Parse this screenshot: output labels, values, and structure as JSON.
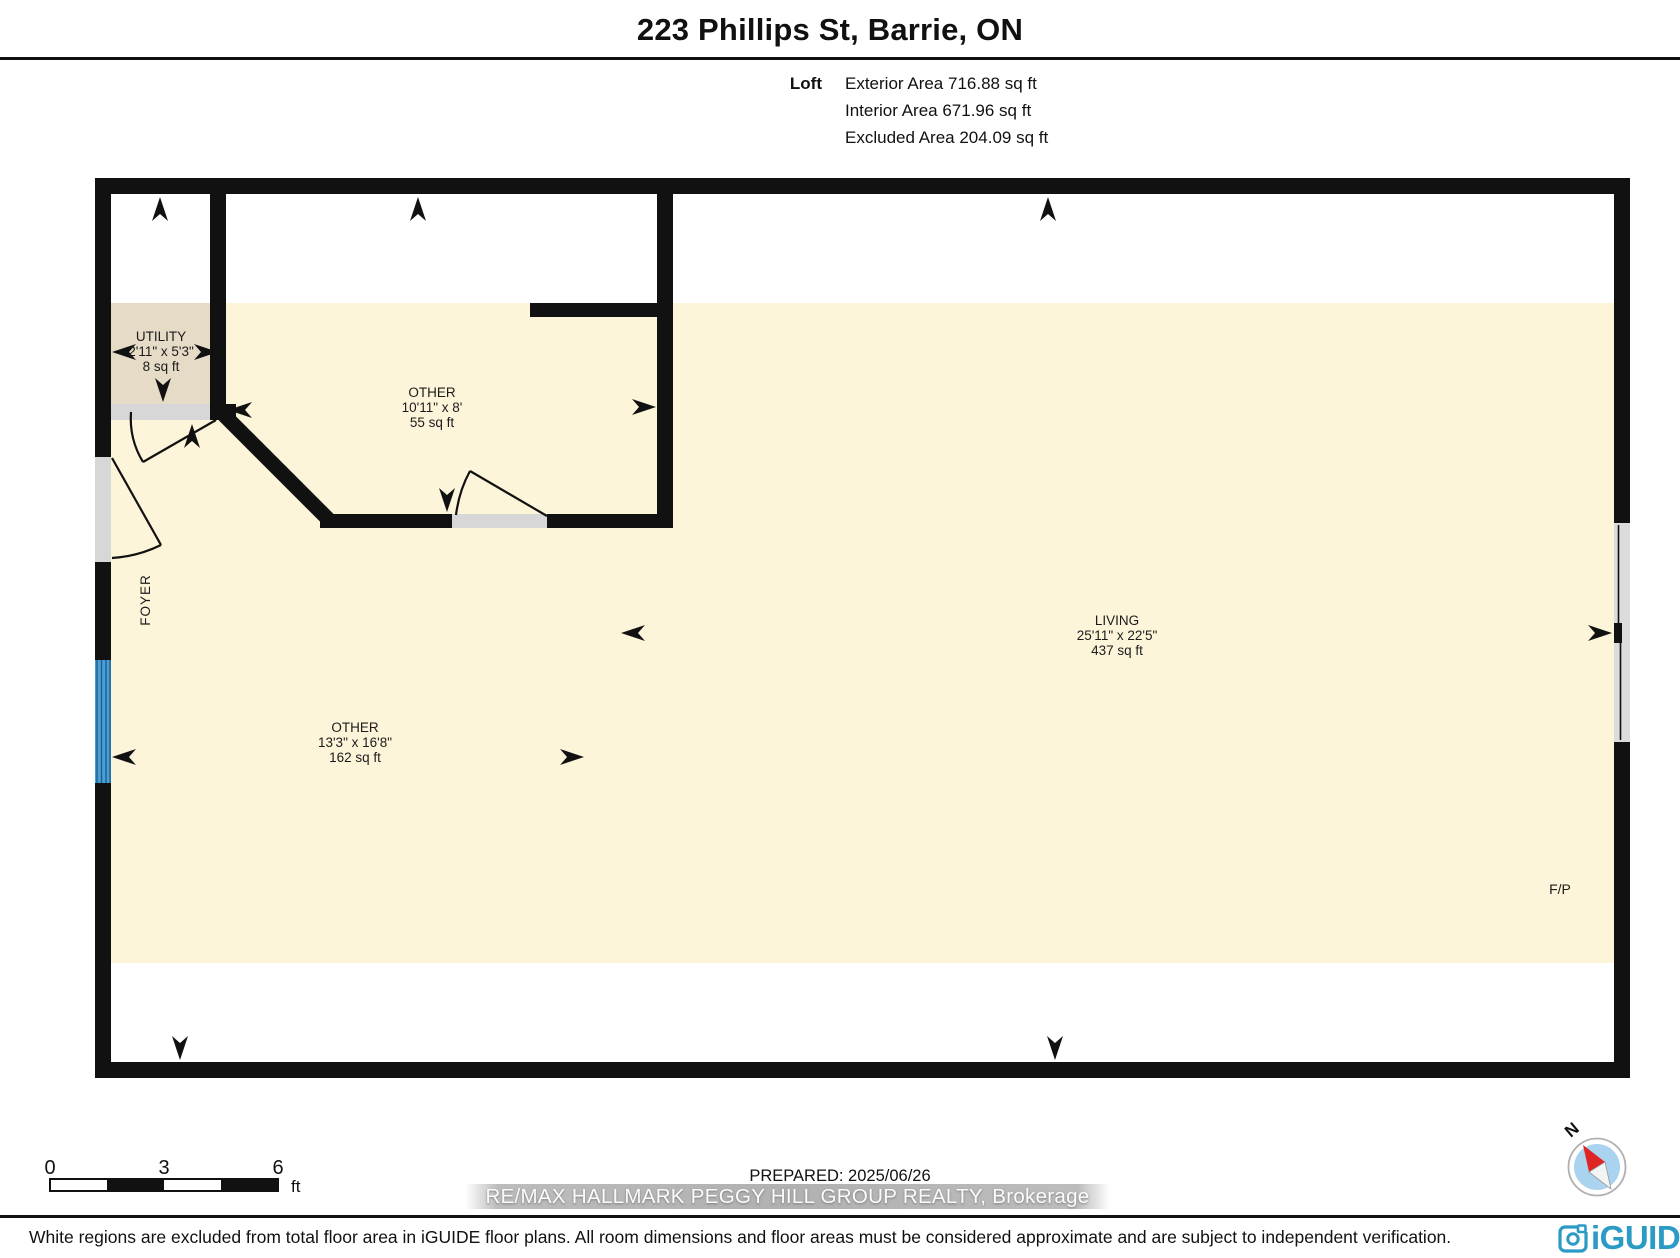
{
  "header": {
    "title": "223 Phillips St, Barrie, ON",
    "area_rows": [
      {
        "label": "Loft",
        "value": "Exterior Area 716.88 sq ft"
      },
      {
        "label": "",
        "value": "Interior Area 671.96 sq ft"
      },
      {
        "label": "",
        "value": "Excluded Area 204.09 sq ft"
      }
    ]
  },
  "rooms": {
    "utility": {
      "name": "UTILITY",
      "dims": "2'11\" x 5'3\"",
      "area": "8 sq ft"
    },
    "other1": {
      "name": "OTHER",
      "dims": "10'11\" x 8'",
      "area": "55 sq ft"
    },
    "foyer": {
      "name": "FOYER"
    },
    "other2": {
      "name": "OTHER",
      "dims": "13'3\" x 16'8\"",
      "area": "162 sq ft"
    },
    "living": {
      "name": "LIVING",
      "dims": "25'11\" x 22'5\"",
      "area": "437 sq ft"
    },
    "fireplace": {
      "label": "F/P"
    }
  },
  "scale_bar": {
    "tick0": "0",
    "tick1": "3",
    "tick2": "6",
    "unit": "ft"
  },
  "compass": {
    "north_label": "N"
  },
  "prepared_label": "PREPARED: 2025/06/26",
  "watermark_text": "RE/MAX HALLMARK PEGGY HILL GROUP REALTY, Brokerage",
  "footer": {
    "disclaimer": "White regions are excluded from total floor area in iGUIDE floor plans. All room dimensions and floor areas must be considered approximate and are subject to independent verification.",
    "brand": "iGUIDE"
  },
  "colors": {
    "floor_cream": "#fdf5d9",
    "floor_tan": "#e6dbc7",
    "wall_black": "#111111",
    "threshold_gray": "#d7d7d7",
    "window_blue": "#4aa0d5",
    "window_pane_dark": "#1e5d8f",
    "right_window_gray": "#dcdcdc",
    "brand_blue": "#2b9bc6",
    "compass_red": "#e02424",
    "compass_inner_blue": "#a9d3ee"
  }
}
